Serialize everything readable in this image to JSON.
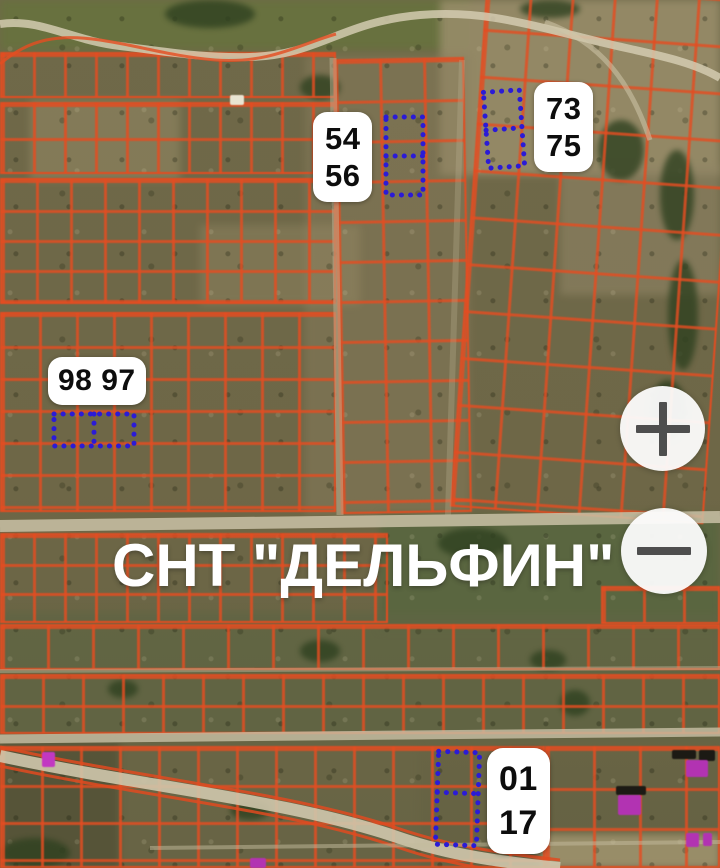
{
  "map": {
    "title": "СНТ \"ДЕЛЬФИН\"",
    "type": "satellite-cadastral-map",
    "labels": [
      {
        "id": "plots-54-56",
        "lines": [
          "54",
          "56"
        ]
      },
      {
        "id": "plots-73-75",
        "lines": [
          "73",
          "75"
        ]
      },
      {
        "id": "plots-98-97",
        "lines": [
          "98 97"
        ]
      },
      {
        "id": "plots-01-17",
        "lines": [
          "01",
          "17"
        ]
      }
    ],
    "markers": [
      {
        "id": "marker-54-56",
        "cells": 2,
        "orientation": "vertical"
      },
      {
        "id": "marker-73-75",
        "cells": 2,
        "orientation": "vertical"
      },
      {
        "id": "marker-98-97",
        "cells": 2,
        "orientation": "horizontal"
      },
      {
        "id": "marker-01-17",
        "cells": 2,
        "orientation": "vertical"
      }
    ],
    "colors": {
      "grid_line": "#e44d21",
      "marker_blue": "#2b1bd6",
      "label_bg": "#ffffff",
      "label_text": "#0d0d0d",
      "title_text": "#ffffff",
      "road": "#cfc7ac"
    }
  },
  "controls": {
    "zoom_in_icon": "plus-icon",
    "zoom_out_icon": "minus-icon"
  }
}
